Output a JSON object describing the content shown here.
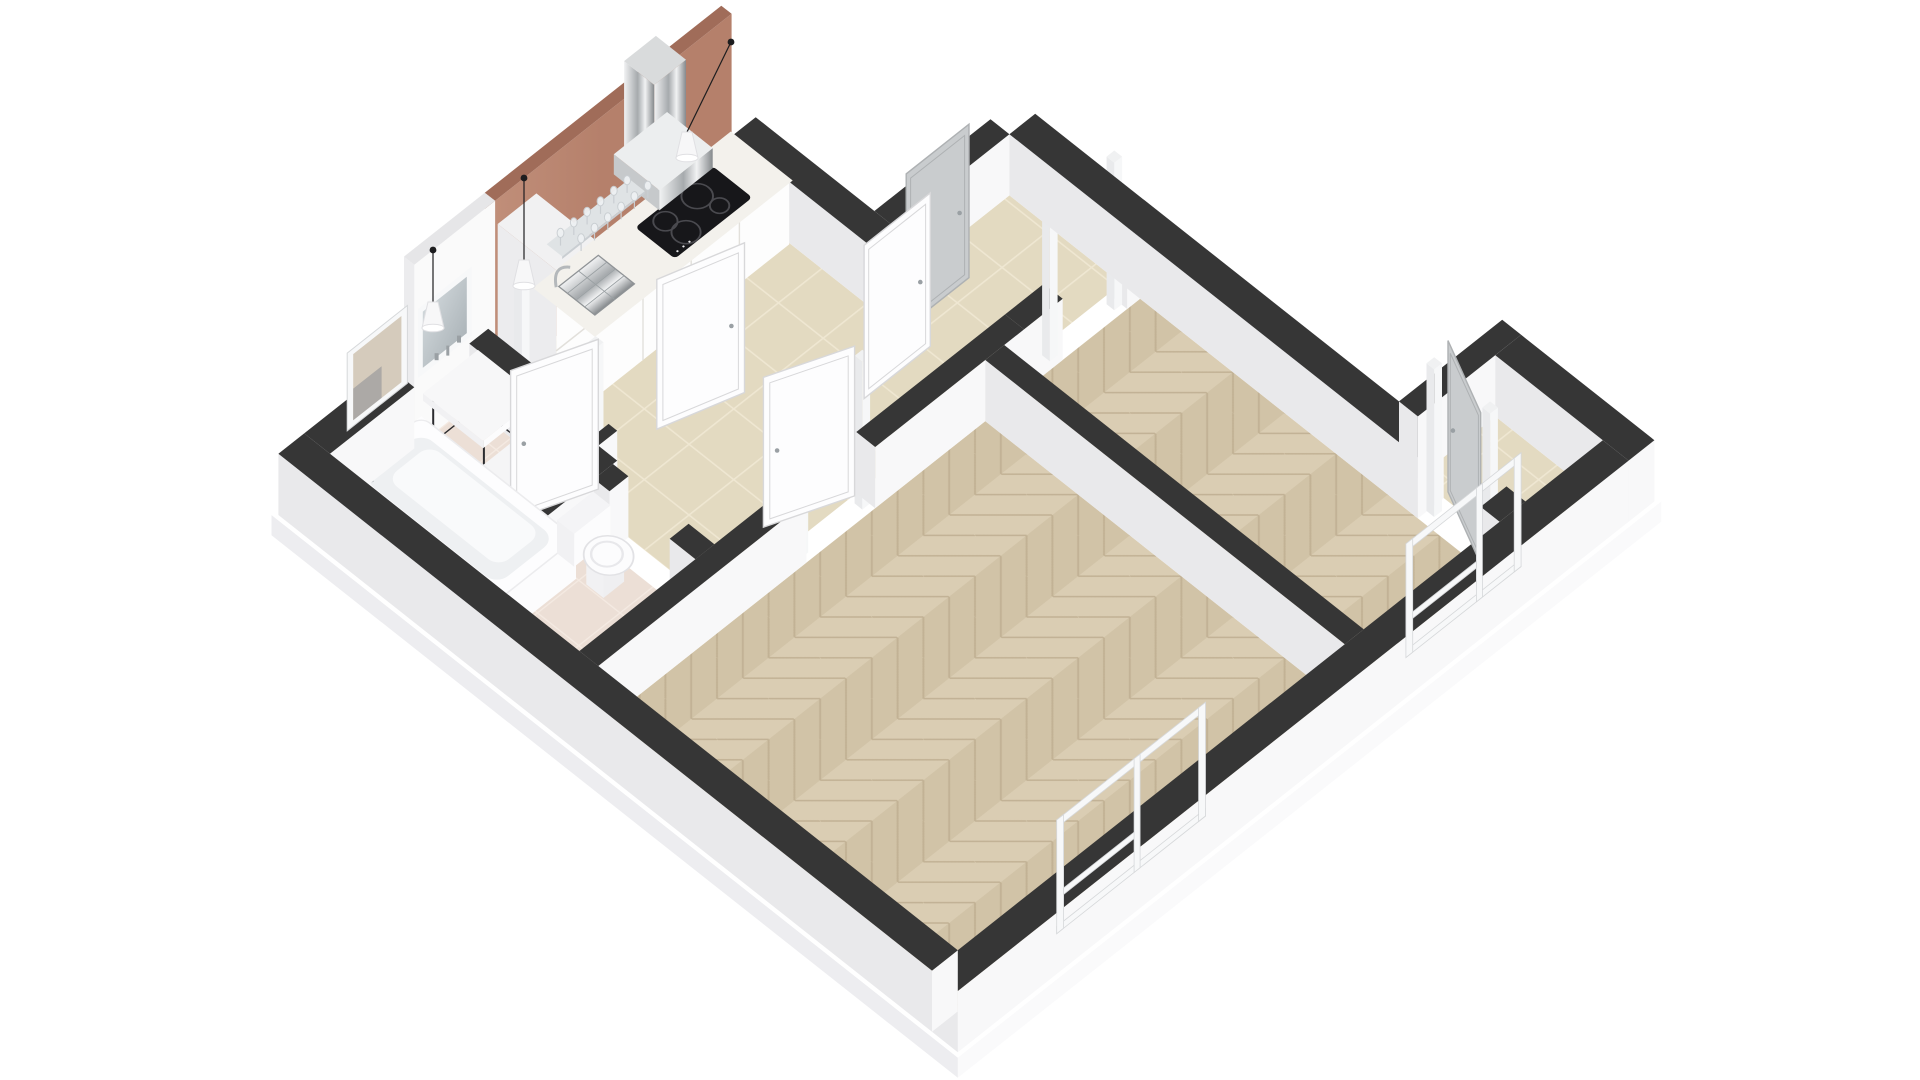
{
  "scene": {
    "type": "3d-floorplan-render",
    "view": "axonometric-dollhouse",
    "background": "#ffffff",
    "rooms": [
      {
        "id": "bathroom",
        "floor": "bath-tile",
        "fixtures": [
          "bathtub",
          "tub-faucet",
          "vanity-basin",
          "vanity-frame",
          "vanity-mirror",
          "wall-taps",
          "laundry-box",
          "bathroom-window"
        ]
      },
      {
        "id": "wc",
        "floor": "bath-tile",
        "fixtures": [
          "toilet"
        ]
      },
      {
        "id": "kitchen-hall",
        "floor": "hall-tile",
        "fixtures": [
          "accent-wall",
          "kitchen-counter",
          "tall-cabinet",
          "induction-cooktop",
          "kitchen-sink",
          "kitchen-faucet",
          "range-hood",
          "glass-shelf",
          "wine-glasses",
          "pendant-lights"
        ]
      },
      {
        "id": "living-room",
        "floor": "herringbone-parquet",
        "fixtures": [
          "living-room-window"
        ]
      },
      {
        "id": "bedroom",
        "floor": "herringbone-parquet",
        "fixtures": [
          "bedroom-window",
          "entry-niche"
        ]
      }
    ],
    "doors": [
      "bathroom-door",
      "hall-door",
      "living-room-door",
      "corridor-door-white",
      "corridor-door-grey",
      "niche-door-grey"
    ],
    "windows": [
      "bathroom-window",
      "living-room-window",
      "bedroom-window"
    ],
    "pendant_count": 3,
    "wine_glass_count": 12,
    "cooktop_ring_count": 4
  },
  "colors": {
    "bg": "#ffffff",
    "wallTop": "#363636",
    "wallTopLight": "#e6e6e8",
    "wallFaceSE": "#f8f8f9",
    "wallFaceSW": "#e9e9eb",
    "slabTop": "#ffffff",
    "slabSideSE": "#fafafb",
    "slabSideSW": "#ededf0",
    "terracotta": "#b5806b",
    "terracottaLight": "#c08e79",
    "terracottaTop": "#a06c59",
    "terracottaCap": "#9b6955",
    "parquetA": "#dacdb3",
    "parquetB": "#d1c3a7",
    "parquetLine": "#c2b295",
    "hallTile": "#e3dac1",
    "hallGrout": "#efe7d2",
    "bathTile": "#ecdfd6",
    "bathGrout": "#f4eae2",
    "counterTop": "#f3f1ec",
    "counterFace": "#fdfdfd",
    "counterSeam": "#e2e0db",
    "counterSW": "#ececee",
    "cooktop": "#17171a",
    "cooktopRing": "#4a4a4f",
    "cooktopDot": "#e8e8ea",
    "steelLight": "#f1f2f3",
    "steelMid": "#a6aaad",
    "steelDark": "#85898c",
    "fixtureWhite": "#fcfcfd",
    "fixtureShade": "#efeff1",
    "fixtureSW": "#f1f1f3",
    "tubInner": "#eef0f2",
    "tubFloor": "#f9fafb",
    "doorWhite": "#fdfdfe",
    "doorEdge": "#d8d8da",
    "doorGrey": "#c9ccce",
    "doorGreyEdge": "#aeb1b3",
    "handle": "#9aa0a4",
    "frameWhite": "#f7f8f9",
    "frameEdge": "#d6d8da",
    "mirrorA": "#dde3e6",
    "mirrorB": "#9fa8ad",
    "glass": "#eef1f3",
    "glassEdge": "#c9ced2",
    "metalFrame": "#2b2b2e",
    "cord": "#1d1d1f",
    "pendant": "#f7f7f8",
    "pendantEdge": "#e0e0e3",
    "nicheBeige": "#d5cbbc",
    "nicheShadow": "#97979a"
  }
}
